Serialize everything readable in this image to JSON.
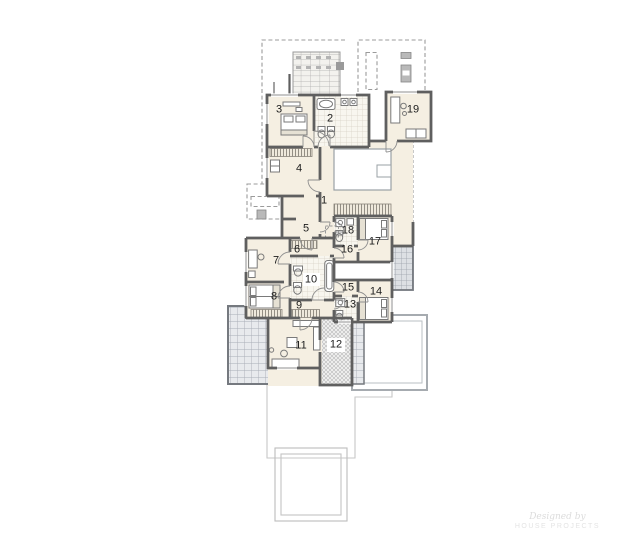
{
  "plan": {
    "type": "floor-plan-upper-storey",
    "rooms": {
      "r1": "1",
      "r2": "2",
      "r3": "3",
      "r4": "4",
      "r5": "5",
      "r6": "6",
      "r7": "7",
      "r8": "8",
      "r9": "9",
      "r10": "10",
      "r11": "11",
      "r12": "12",
      "r13": "13",
      "r14": "14",
      "r15": "15",
      "r16": "16",
      "r17": "17",
      "r18": "18",
      "r19": "19"
    },
    "watermark": {
      "line1": "Designed by",
      "line2": "HOUSE PROJECTS"
    },
    "colors": {
      "floor": "#f5efe2",
      "wall": "#5f5f5f",
      "bath_tile": "#f8f6ef",
      "bath_tile_line": "#d7d2c6",
      "terrace_tile": "#e8eaed",
      "terrace_tile_line": "#a9aeb6",
      "balcony_tile": "#dde0e4",
      "roof_dashed_line": "#9b9b9b",
      "lower_floor_line": "#c7c7c7"
    }
  }
}
